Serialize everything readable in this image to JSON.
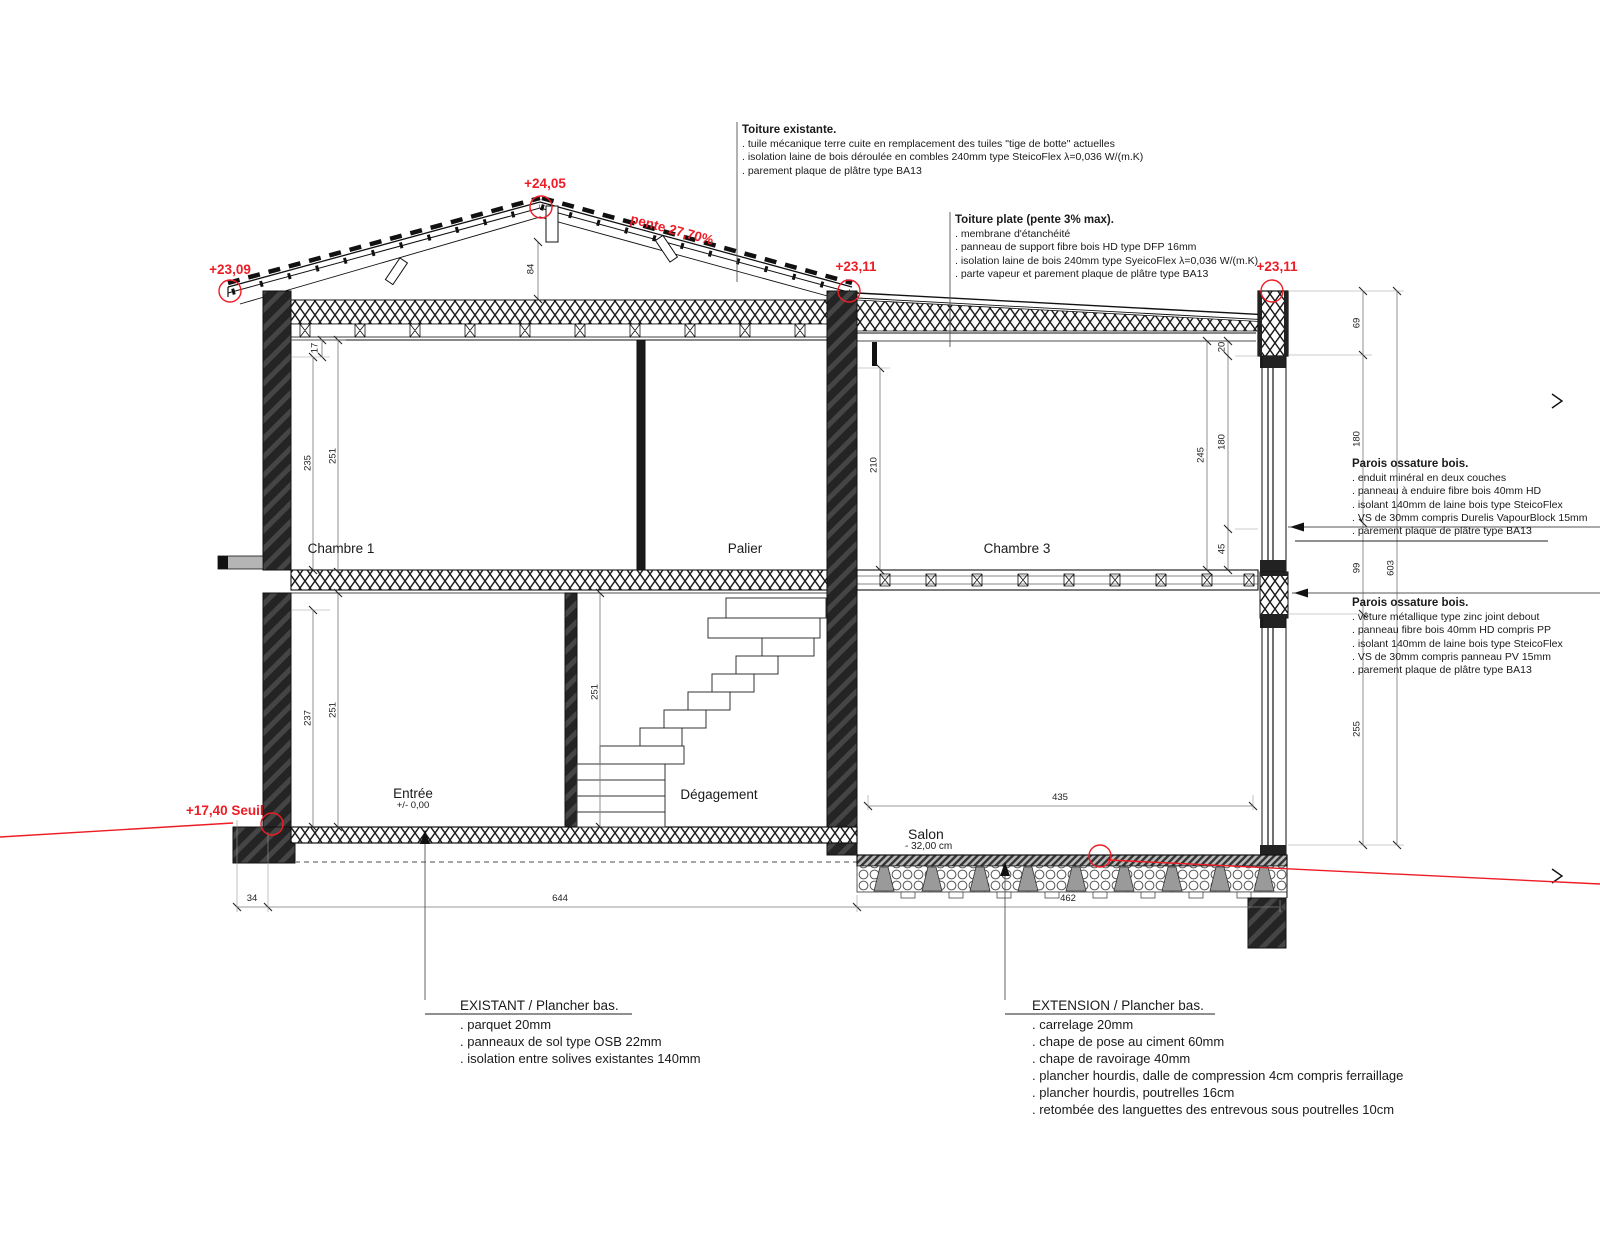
{
  "drawing_title": "Coupe - maison existante et extension",
  "colors": {
    "accent_red": "#ee1c25",
    "line": "#1a1a1a"
  },
  "levels": {
    "ridge": "+24,05",
    "eave_left": "+23,09",
    "eave_center": "+23,11",
    "flat_roof_right": "+23,11",
    "seuil": "+17,40 Seuil"
  },
  "slope_label": "pente 27,70%",
  "rooms": {
    "chambre1": "Chambre 1",
    "palier": "Palier",
    "chambre3": "Chambre 3",
    "entree": "Entrée",
    "entree_level": "+/- 0,00",
    "degagement": "Dégagement",
    "salon": "Salon",
    "salon_level": "- 32,00 cm"
  },
  "annotations": {
    "toiture_existante": {
      "title": "Toiture existante.",
      "items": [
        ". tuile mécanique terre cuite en remplacement des tuiles \"tige de botte\" actuelles",
        ". isolation laine de bois déroulée en combles 240mm type SteicoFlex  λ=0,036 W/(m.K)",
        ". parement plaque de plâtre type BA13"
      ]
    },
    "toiture_plate": {
      "title": "Toiture plate (pente 3% max).",
      "items": [
        ". membrane d'étanchéité",
        ". panneau de support fibre bois HD type DFP 16mm",
        ". isolation laine de bois 240mm type SyeicoFlex λ=0,036 W/(m.K)",
        ". parte vapeur et parement plaque de plâtre type BA13"
      ]
    },
    "parois_haut": {
      "title": "Parois ossature bois.",
      "items": [
        ". enduit minéral en deux couches",
        ". panneau à enduire fibre bois 40mm HD",
        ". isolant 140mm de laine bois type SteicoFlex",
        ". VS de 30mm compris Durelis VapourBlock 15mm",
        ". parement plaque de plâtre type BA13"
      ]
    },
    "parois_bas": {
      "title": "Parois ossature bois.",
      "items": [
        ". vêture métallique type zinc joint debout",
        ". panneau fibre bois 40mm HD compris PP",
        ". isolant 140mm de laine bois type SteicoFlex",
        ". VS de 30mm compris panneau PV 15mm",
        ". parement plaque de plâtre type BA13"
      ]
    },
    "existant_plancher": {
      "title": "EXISTANT / Plancher bas.",
      "items": [
        ". parquet 20mm",
        ". panneaux de sol type OSB 22mm",
        ". isolation entre solives existantes 140mm"
      ]
    },
    "extension_plancher": {
      "title": "EXTENSION / Plancher bas.",
      "items": [
        ". carrelage 20mm",
        ". chape de pose au ciment 60mm",
        ". chape de ravoirage 40mm",
        ". plancher hourdis, dalle de compression 4cm compris ferraillage",
        ". plancher hourdis, poutrelles 16cm",
        ". retombée des languettes des entrevous sous poutrelles 10cm"
      ]
    }
  },
  "dims": {
    "a17": "17",
    "a235": "235",
    "a251": "251",
    "b237": "237",
    "b251": "251",
    "stair251": "251",
    "c210": "210",
    "d245": "245",
    "d20": "20",
    "d180": "180",
    "d45": "45",
    "e69": "69",
    "e180": "180",
    "e99": "99",
    "e255": "255",
    "e603": "603",
    "f84": "84",
    "g435": "435",
    "h34": "34",
    "h644": "644",
    "h462": "462"
  }
}
